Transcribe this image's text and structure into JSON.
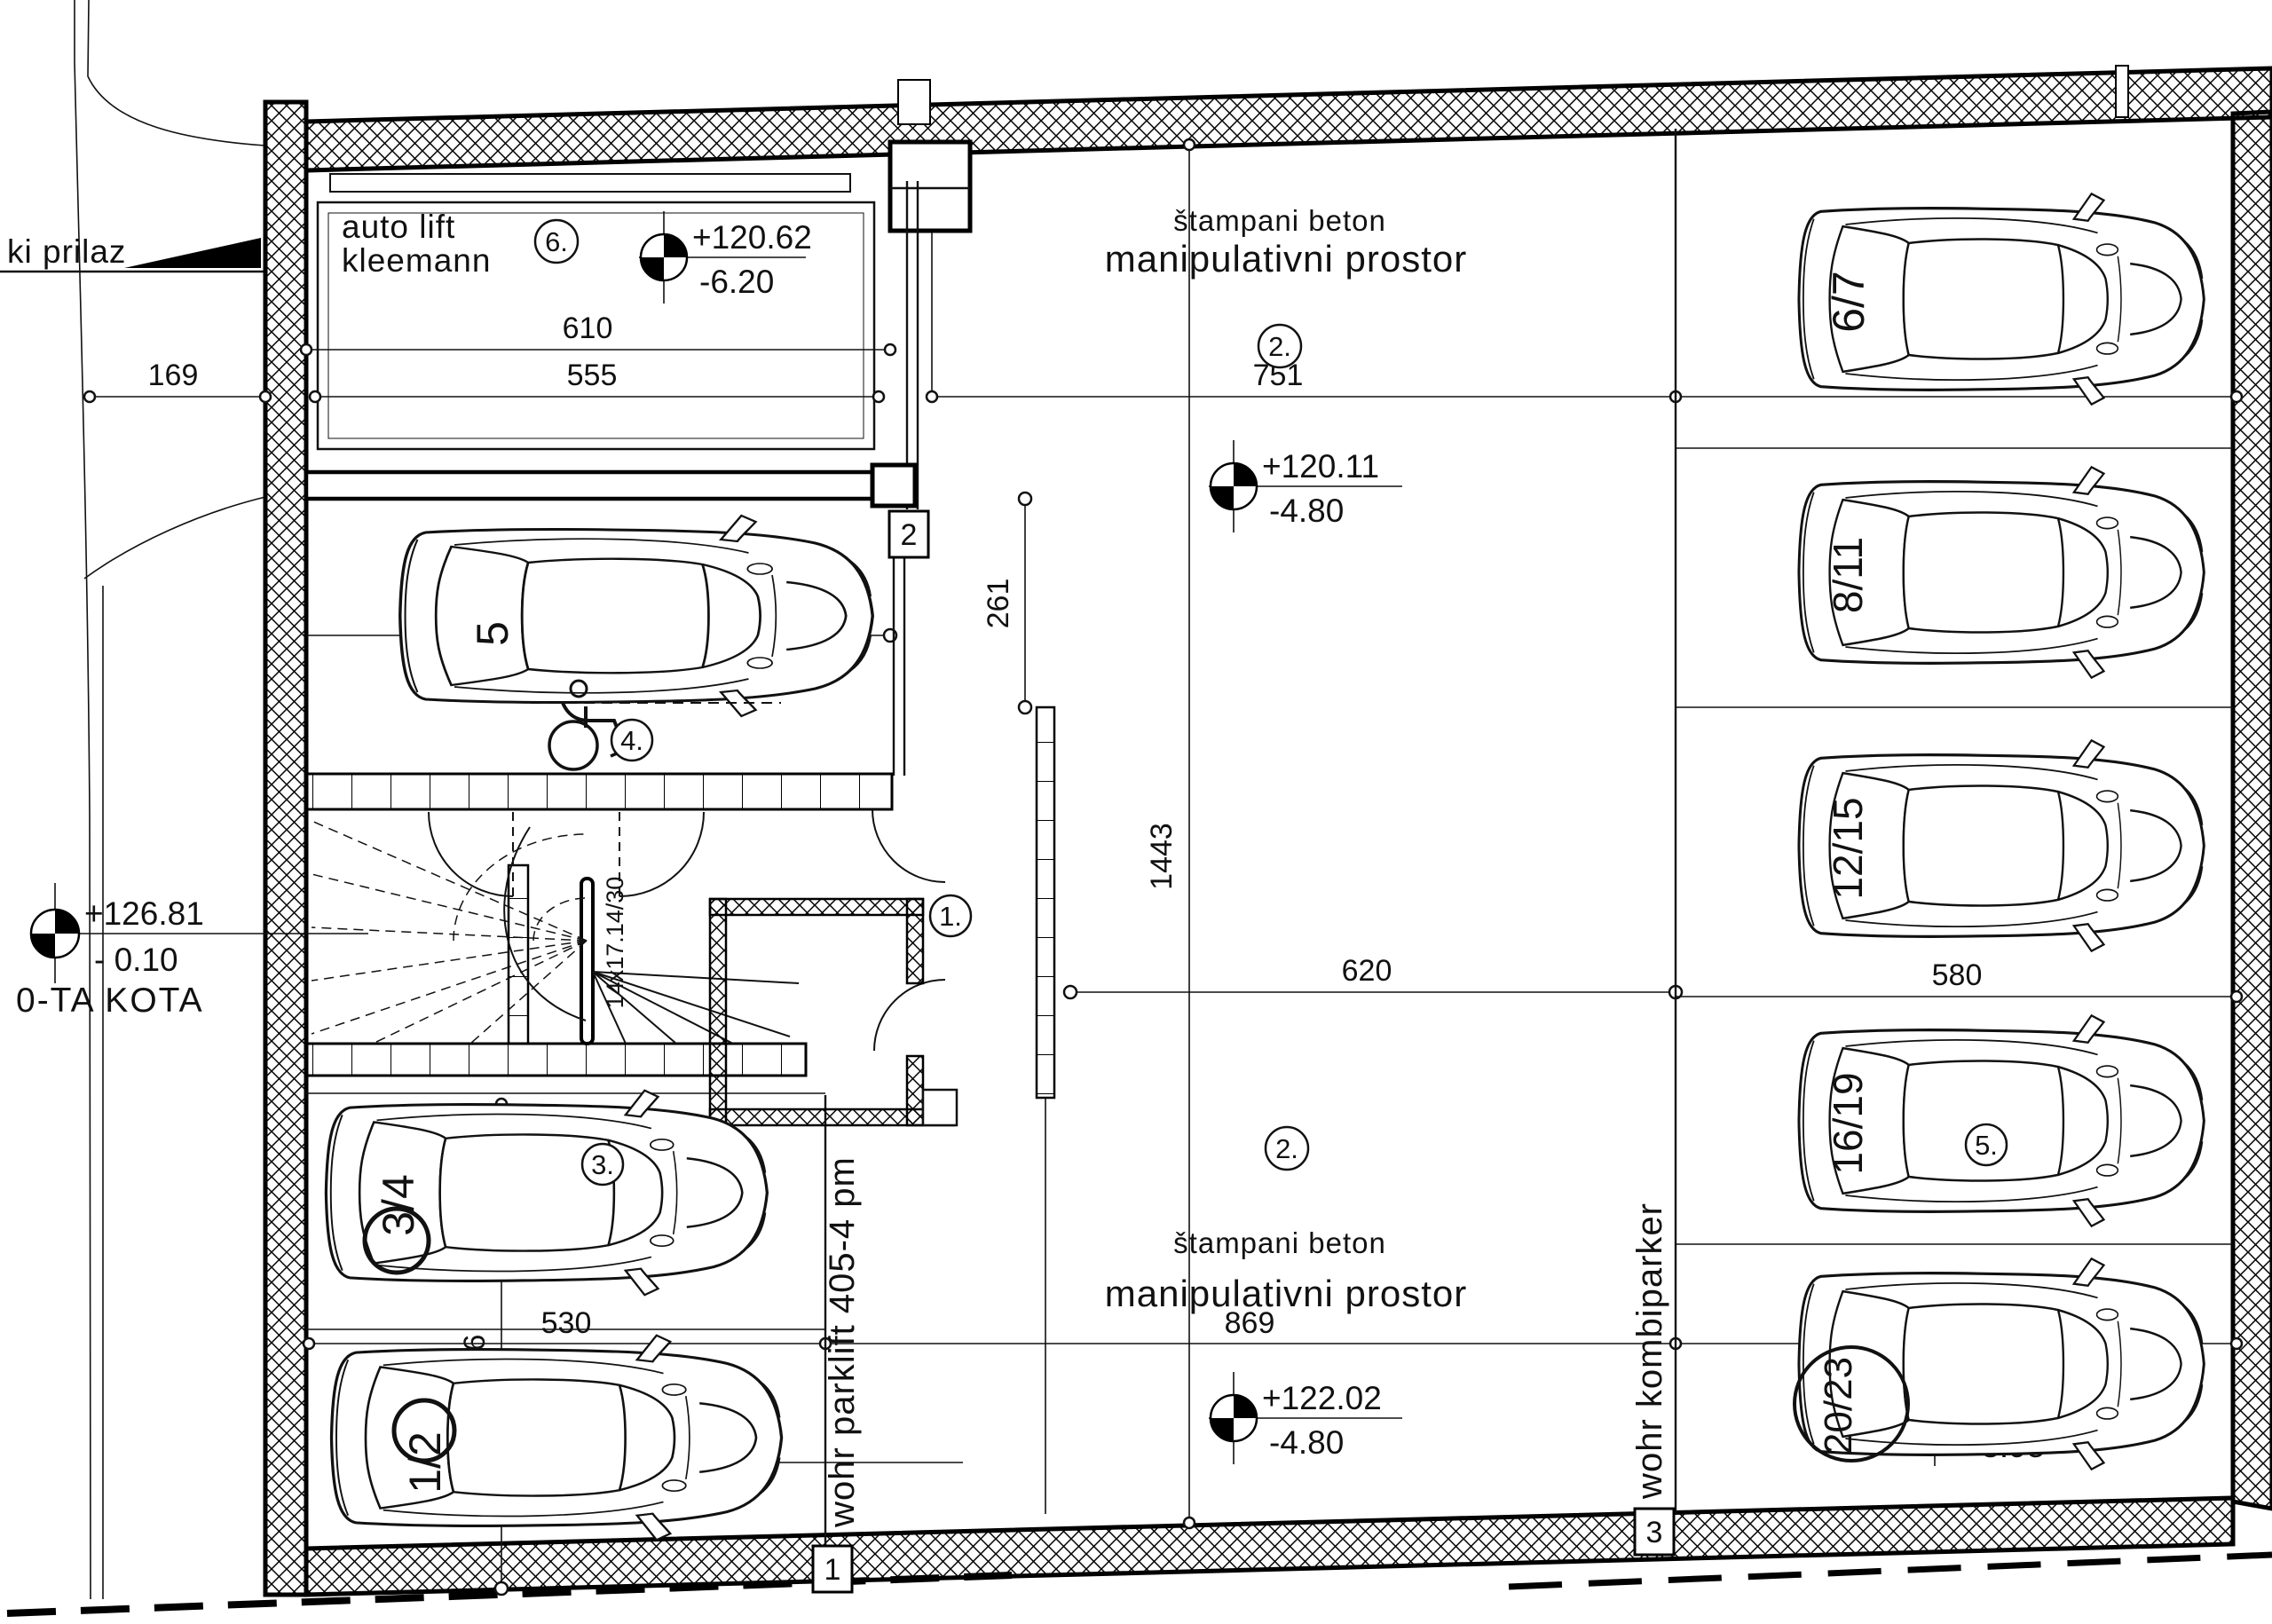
{
  "plan": {
    "entrance_label": "ki prilaz",
    "benchmark": {
      "abs": "+126.81",
      "rel": "- 0.10",
      "name": "0-TA KOTA"
    },
    "autolift": {
      "l1": "auto lift",
      "l2": "kleemann",
      "bubble": "6."
    },
    "elev": {
      "lift": {
        "abs": "+120.62",
        "rel": "-6.20"
      },
      "top": {
        "abs": "+120.11",
        "rel": "-4.80"
      },
      "mid": {
        "abs": "+122.02",
        "rel": "-4.80"
      },
      "parklift": {
        "abs": "+120.31",
        "rel": "-6.60"
      },
      "kombi": {
        "abs": "+115.96",
        "rel": "-8.95"
      }
    },
    "area_top": {
      "material": "štampani beton",
      "name": "manipulativni prostor",
      "bubble": "2."
    },
    "area_bottom": {
      "material": "štampani beton",
      "name": "manipulativni prostor",
      "bubble": "2."
    },
    "dims": {
      "d169": "169",
      "d610": "610",
      "d555": "555",
      "d751": "751",
      "d580a": "580",
      "d609": "609",
      "d261": "261",
      "d1443": "1443",
      "d620": "620",
      "d580b": "580",
      "d496": "496",
      "d530": "530",
      "d869": "869",
      "d580c": "580"
    },
    "stair_label": "14x17.14/30",
    "grid": {
      "g1": "1",
      "g2": "2",
      "g3": "3"
    },
    "bubbles": {
      "room": "1.",
      "access": "4.",
      "car34": "3.",
      "car1619": "5."
    },
    "equip": {
      "parklift": "wohr parklift 405-4 pm",
      "kombi": "wohr kombiparker"
    },
    "stalls": {
      "s5": "5",
      "s34": "3/4",
      "s12": "1/2",
      "s67": "6/7",
      "s811": "8/11",
      "s1215": "12/15",
      "s1619": "16/19",
      "s2023": "20/23"
    }
  }
}
